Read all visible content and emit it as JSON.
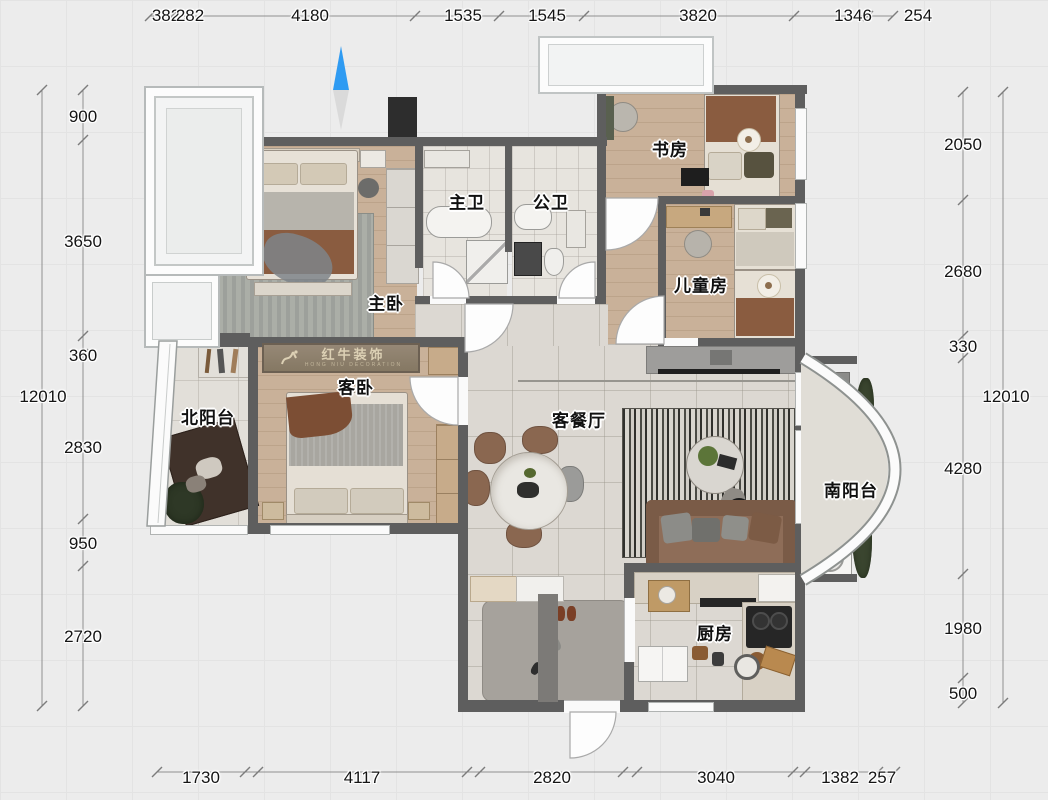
{
  "logo": {
    "title": "红牛装饰",
    "subtitle": "HONG NIU DECORATION"
  },
  "rooms": {
    "master_bedroom": {
      "label": "主卧"
    },
    "guest_bedroom": {
      "label": "客卧"
    },
    "master_bath": {
      "label": "主卫"
    },
    "public_bath": {
      "label": "公卫"
    },
    "study": {
      "label": "书房"
    },
    "kids_room": {
      "label": "儿童房"
    },
    "north_balcony": {
      "label": "北阳台"
    },
    "living_dining": {
      "label": "客餐厅"
    },
    "south_balcony": {
      "label": "南阳台"
    },
    "kitchen": {
      "label": "厨房"
    }
  },
  "dimensions": {
    "unit": "mm",
    "top": [
      "382",
      "282",
      "4180",
      "1535",
      "1545",
      "3820",
      "1346",
      "254"
    ],
    "bottom": [
      "1730",
      "4117",
      "2820",
      "3040",
      "1382",
      "257"
    ],
    "left": {
      "segments": [
        "900",
        "3650",
        "360",
        "2830",
        "950",
        "2720"
      ],
      "total": "12010"
    },
    "right": {
      "segments": [
        "2050",
        "2680",
        "330",
        "4280",
        "1980",
        "500"
      ],
      "total": "12010"
    }
  },
  "colors": {
    "wall": "#5e5e5e",
    "wood_floor": "#c9b199",
    "tile_floor": "#dcd8d2",
    "north_arrow_blue": "#2f9bf2",
    "logo_background": "#8d8070",
    "logo_text": "#dcd0b4",
    "blanket_brown": "#8a5c40"
  }
}
